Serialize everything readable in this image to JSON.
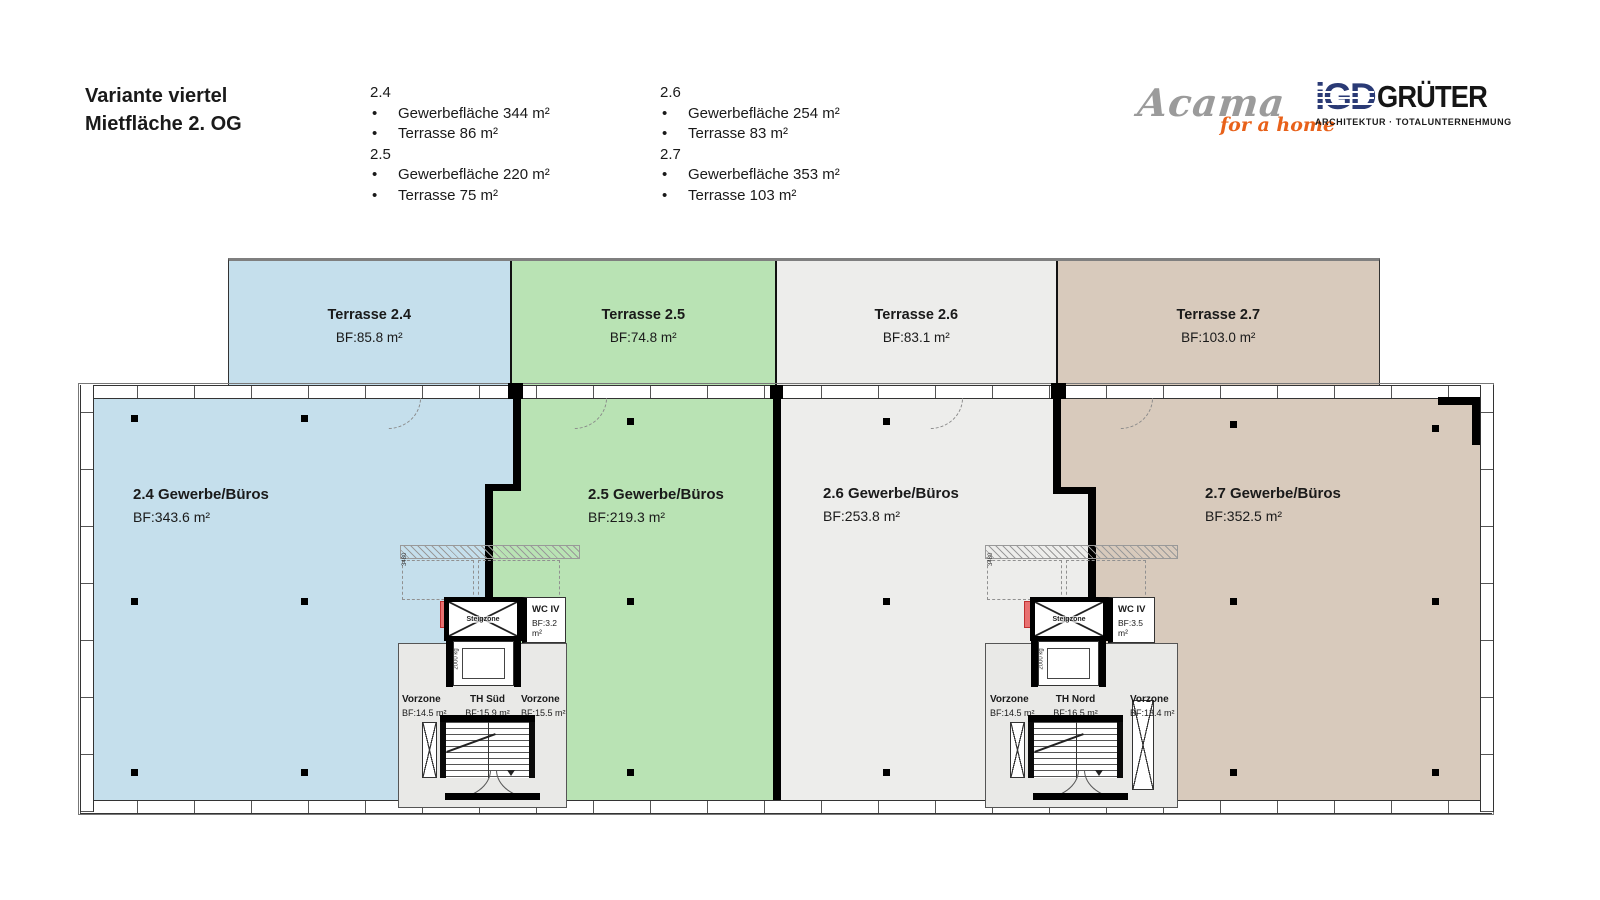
{
  "page": {
    "title_line1": "Variante viertel",
    "title_line2": "Mietfläche 2. OG"
  },
  "legend": {
    "bullet": "•",
    "groups": [
      {
        "id": "2.4",
        "items": [
          "Gewerbefläche 344 m²",
          "Terrasse 86 m²"
        ]
      },
      {
        "id": "2.5",
        "items": [
          "Gewerbefläche 220 m²",
          "Terrasse 75 m²"
        ]
      },
      {
        "id": "2.6",
        "items": [
          "Gewerbefläche 254 m²",
          "Terrasse 83 m²"
        ]
      },
      {
        "id": "2.7",
        "items": [
          "Gewerbefläche 353 m²",
          "Terrasse 103 m²"
        ]
      }
    ]
  },
  "logos": {
    "acama": {
      "wordmark": "Acama",
      "tagline": "for a home"
    },
    "gruter": {
      "mark": "iGD",
      "wordmark": "GRÜTER",
      "tagline": "ARCHITEKTUR · TOTALUNTERNEHMUNG"
    }
  },
  "plan": {
    "terraces": [
      {
        "label": "Terrasse 2.4",
        "area": "BF:85.8 m²"
      },
      {
        "label": "Terrasse 2.5",
        "area": "BF:74.8 m²"
      },
      {
        "label": "Terrasse 2.6",
        "area": "BF:83.1 m²"
      },
      {
        "label": "Terrasse 2.7",
        "area": "BF:103.0 m²"
      }
    ],
    "units": [
      {
        "label": "2.4 Gewerbe/Büros",
        "area": "BF:343.6 m²"
      },
      {
        "label": "2.5 Gewerbe/Büros",
        "area": "BF:219.3 m²"
      },
      {
        "label": "2.6 Gewerbe/Büros",
        "area": "BF:253.8 m²"
      },
      {
        "label": "2.7 Gewerbe/Büros",
        "area": "BF:352.5 m²"
      }
    ],
    "cores": [
      {
        "stair_label": "TH Süd",
        "stair_area": "BF:15.9 m²",
        "vorzone_left_label": "Vorzone",
        "vorzone_left_area": "BF:14.5 m²",
        "vorzone_right_label": "Vorzone",
        "vorzone_right_area": "BF:15.5 m²",
        "wc_label": "WC IV",
        "wc_area": "BF:3.2 m²",
        "shaft_label": "Steigzone"
      },
      {
        "stair_label": "TH Nord",
        "stair_area": "BF:16.5 m²",
        "vorzone_left_label": "Vorzone",
        "vorzone_left_area": "BF:14.5 m²",
        "vorzone_right_label": "Vorzone",
        "vorzone_right_area": "BF:13.4 m²",
        "wc_label": "WC IV",
        "wc_area": "BF:3.5 m²",
        "shaft_label": "Steigzone"
      }
    ],
    "dimension_label": "3480",
    "elevator_label": "2000 kg",
    "colors": {
      "unit_24_blue": "#c5dfec",
      "unit_25_green": "#b9e3b4",
      "unit_26_gray": "#ededeb",
      "unit_27_beige": "#d8cabc",
      "core_gray": "#e9e9e7",
      "wall_black": "#000000",
      "accent_red": "#e87070",
      "acama_gray": "#9b9b9b",
      "acama_orange": "#e8611a",
      "gruter_blue": "#2a3a75"
    }
  }
}
